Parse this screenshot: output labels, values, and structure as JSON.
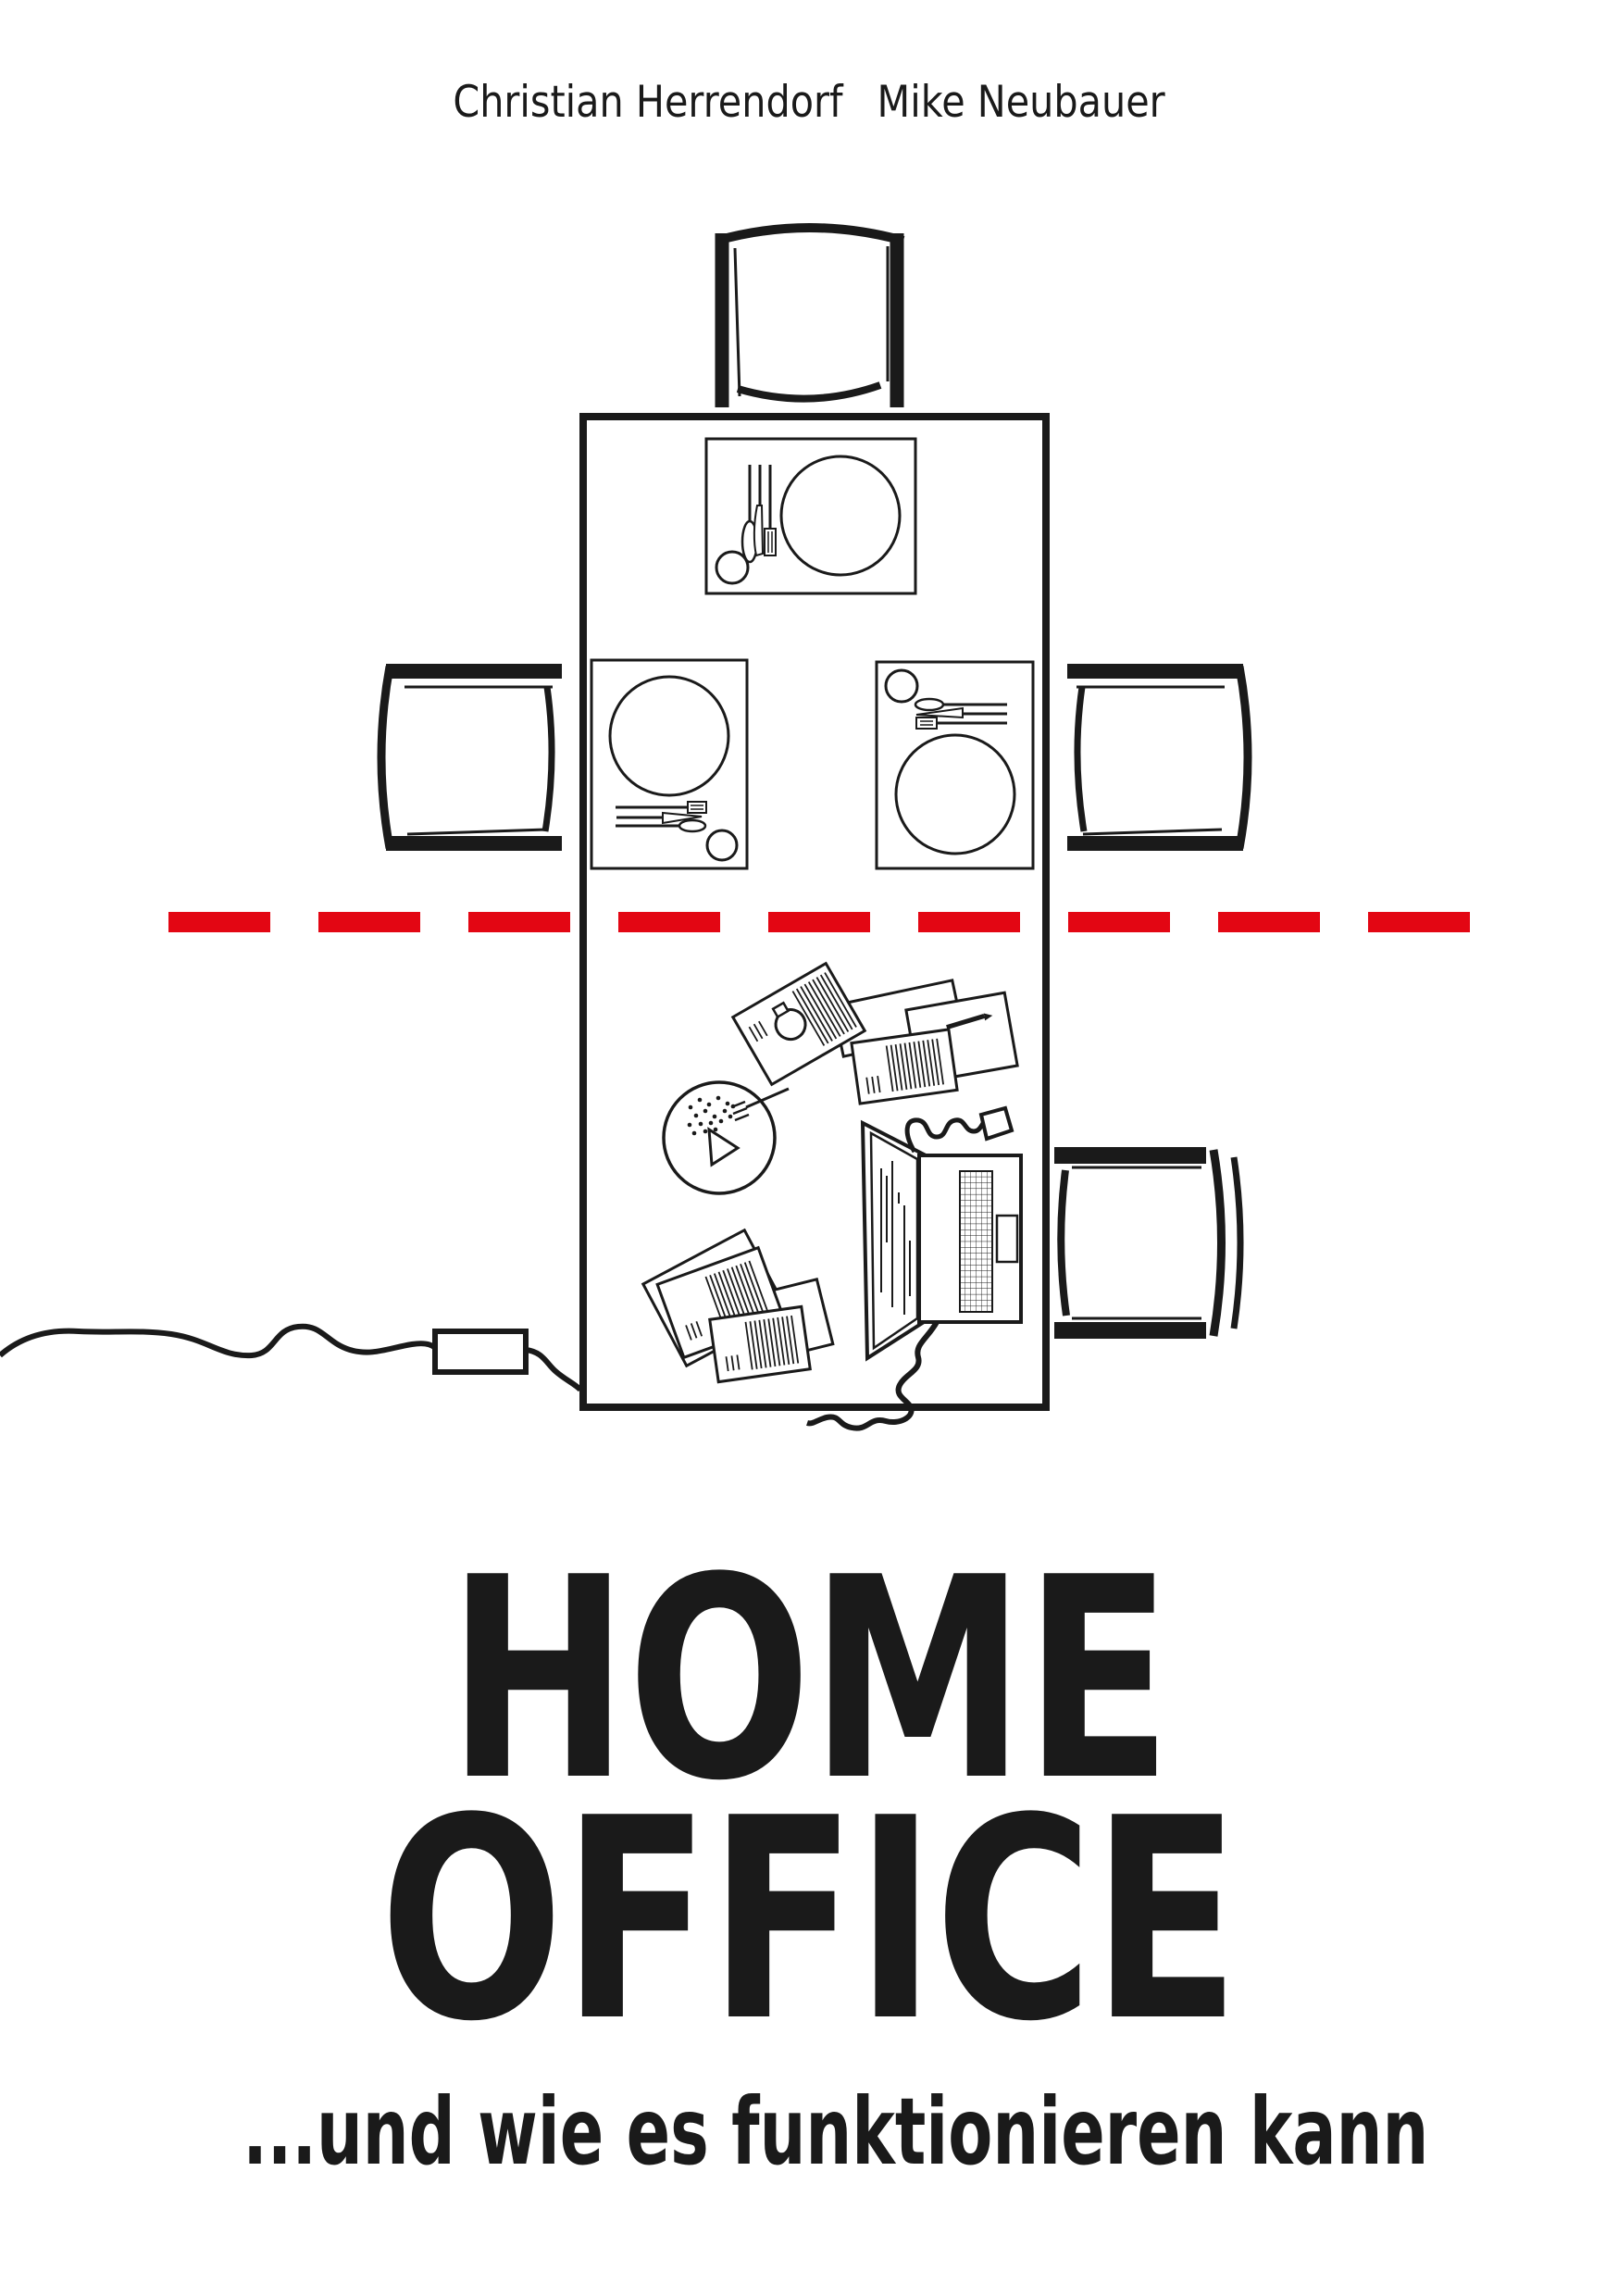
{
  "colors": {
    "background": "#ffffff",
    "ink": "#1a1a1a",
    "accent_red": "#e30613"
  },
  "header": {
    "author_1": "Christian Herrendorf",
    "author_2": "Mike Neubauer"
  },
  "title": {
    "line1": "HOME",
    "line2": "OFFICE",
    "subtitle": "...und wie es funktionieren kann"
  },
  "illustration": {
    "icons": [
      "dining-table-icon",
      "chair-top-icon",
      "chair-left-icon",
      "chair-right-icon",
      "chair-bottom-right-icon",
      "place-setting-top-icon",
      "place-setting-left-icon",
      "place-setting-right-icon",
      "plate-icon",
      "glass-icon",
      "cutlery-icon",
      "red-dashed-divider-icon",
      "snack-bowl-icon",
      "fork-icon",
      "papers-pile-icon",
      "pen-icon",
      "laptop-icon",
      "power-cable-icon",
      "power-adapter-icon"
    ]
  }
}
